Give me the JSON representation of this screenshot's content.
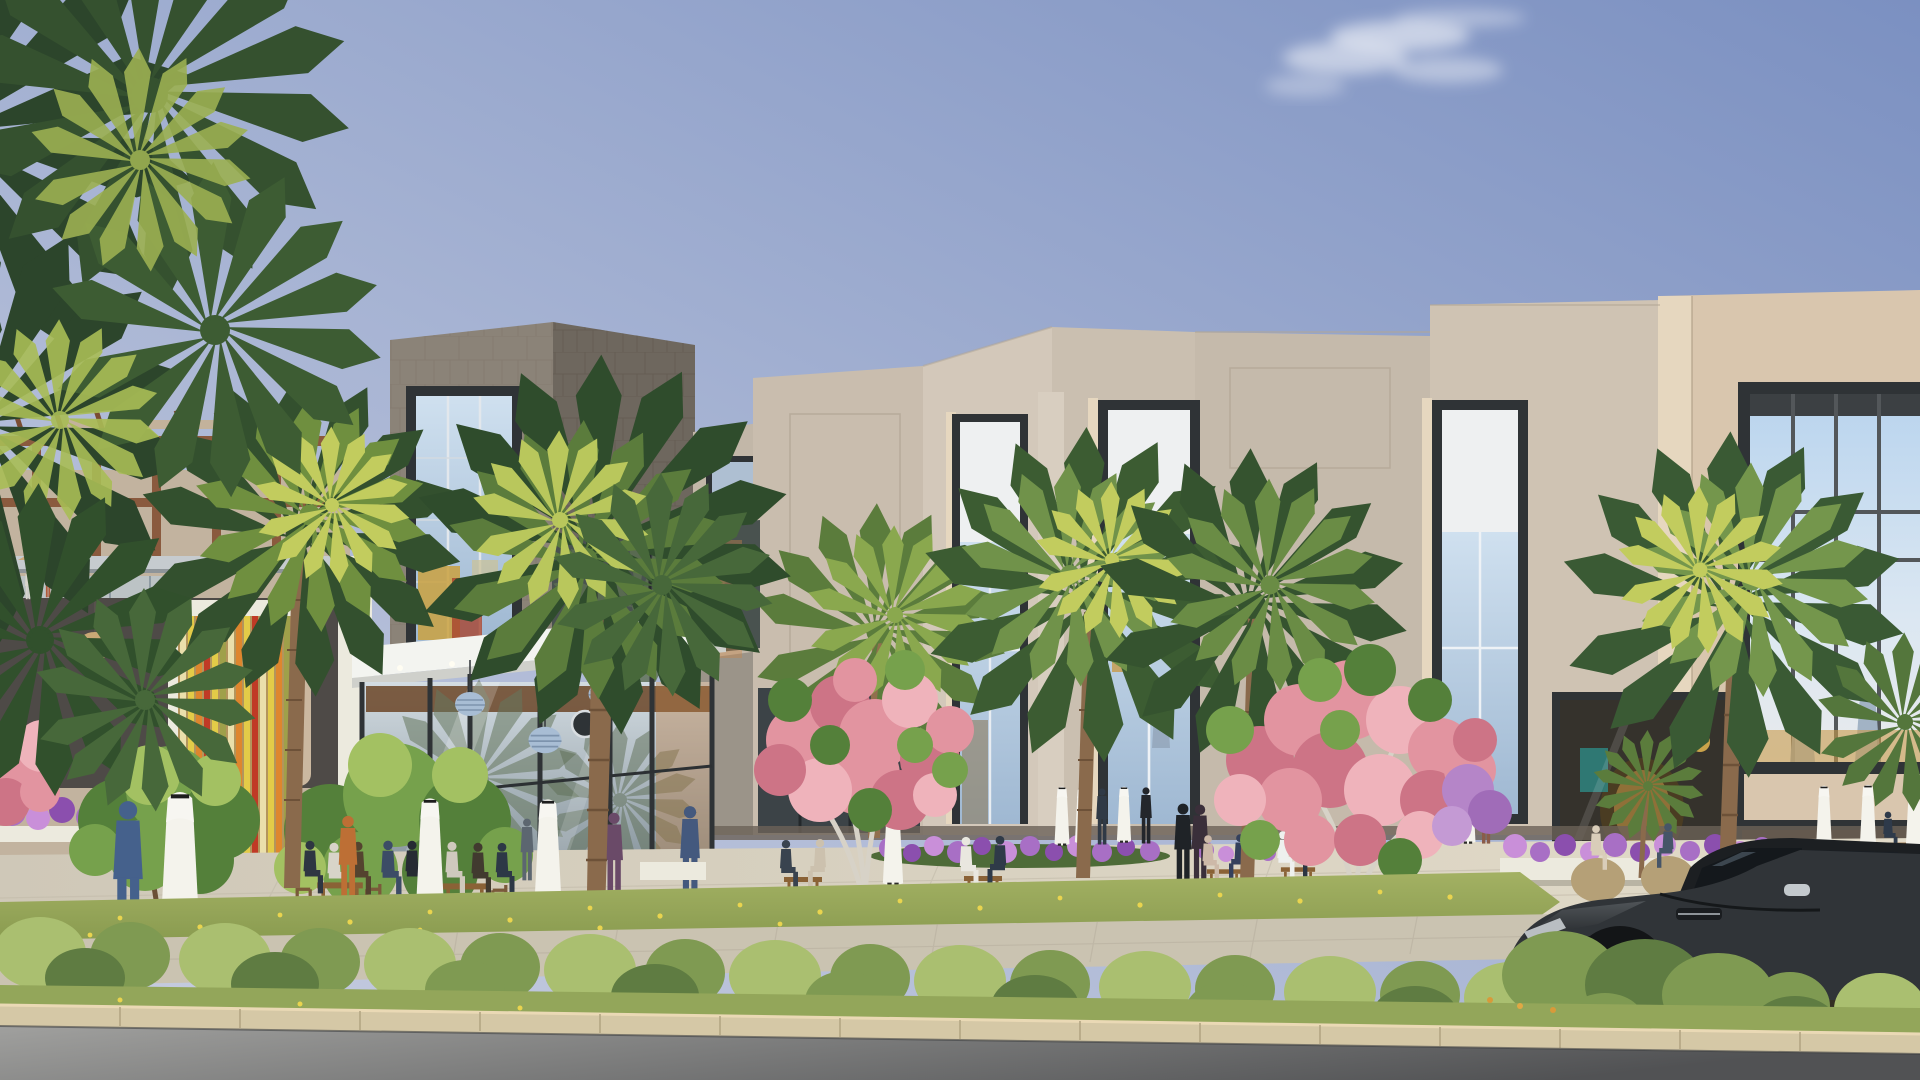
{
  "scene": {
    "type": "architectural-rendering",
    "description": "Daytime exterior rendering of a modern two-storey retail mall with beige stone facades, tall dark-framed shop windows, a grey stone gallery cube, a glass entrance pavilion with pendant lamps, a colourful striped slat wall, fan palms, pink flowering trees, pedestrians in white thobes and abayas, outdoor cafe seating, purple flower beds, a clipped hedge over a stone curb, and a dark luxury coupe parked on the asphalt road in the foreground",
    "elements": [
      {
        "name": "sky",
        "description": "clear blue gradient sky, deeper at top right"
      },
      {
        "name": "cloud",
        "description": "single wispy white cloud upper centre-right"
      },
      {
        "name": "left-terrace-pavilion",
        "description": "two-level terrace with timber pergola, steel frame and rattan pendant lamps"
      },
      {
        "name": "striped-slat-wall",
        "description": "vertical slats in yellow, orange, red, olive and cream"
      },
      {
        "name": "stone-cube-gallery",
        "description": "grey stone-clad cube volume with large mullioned glass wall"
      },
      {
        "name": "main-facade",
        "description": "faceted beige stone facade blocks with stepped parapets"
      },
      {
        "name": "tall-shop-windows",
        "description": "three double-height dark framed windows with roller shades"
      },
      {
        "name": "mannequin-display-window",
        "description": "large gridded window on right block with mannequins"
      },
      {
        "name": "boutique-storefront",
        "description": "warm gold and teal lit boutique interiors at ground level"
      },
      {
        "name": "entrance-glass-pavilion",
        "description": "white canopy glass pavilion with blue pendant lamps and round logo plaque"
      },
      {
        "name": "palm-trees",
        "description": "nine fan palms across the plaza plus overhanging fronds top left"
      },
      {
        "name": "pink-flowering-trees",
        "description": "three pink blossom trees with pale trunks"
      },
      {
        "name": "green-trees",
        "description": "two round leafy green trees at left"
      },
      {
        "name": "pedestrians",
        "description": "about thirty figures: men in white thobes, women in abayas, casual visitors"
      },
      {
        "name": "outdoor-cafe-seating",
        "description": "wooden tables and chairs plus wicker pod chairs"
      },
      {
        "name": "flower-beds",
        "description": "purple petunia beds and lawn dotted with yellow flowers"
      },
      {
        "name": "hedge-and-curb",
        "description": "loose green hedge over beige stone curb blocks"
      },
      {
        "name": "road",
        "description": "asphalt road across the bottom foreground"
      },
      {
        "name": "luxury-coupe",
        "description": "dark grey sports coupe partly hidden behind the hedge, bottom right"
      }
    ]
  },
  "palette": {
    "sky_top": "#7b90c1",
    "sky_mid": "#a6b3d3",
    "sky_low": "#c5cbdf",
    "cloud_white": "#ffffff",
    "stone_front": "#8b8378",
    "stone_side": "#6e675e",
    "facade_light": "#d3c8ba",
    "facade_mid": "#c9bdae",
    "facade_shadow": "#b3a795",
    "facade_warm": "#d9c6ae",
    "facade_lit_edge": "#e6d7bf",
    "frame_dark": "#2f3336",
    "glass_sky": "#bdd3e8",
    "glass_shade": "#eef0f1",
    "canopy_white": "#f3f4f0",
    "stripe_yellow": "#e3cb48",
    "stripe_orange": "#de862e",
    "stripe_red": "#c03a26",
    "stripe_olive": "#9fa04a",
    "stripe_cream": "#eadfab",
    "slat_bg": "#b3955c",
    "pergola_brown": "#8a5a3e",
    "steel_gray": "#c6cbcf",
    "palm_dark": "#33502e",
    "palm_mid": "#5b7c3c",
    "palm_light": "#8aa84e",
    "palm_sun": "#c2cc5e",
    "trunk_brown": "#8a6a4c",
    "pink_blossom": "#e294a0",
    "pink_deep": "#cd7486",
    "pink_light": "#efb3bb",
    "tree_green": "#76a14c",
    "tree_green_dark": "#54803a",
    "tree_green_light": "#a3c162",
    "hedge_green": "#7f9a52",
    "hedge_light": "#aabf70",
    "hedge_dark": "#5f7c42",
    "grass": "#93a65a",
    "flower_yellow": "#e9d44f",
    "flower_purple": "#a86fc5",
    "flower_purple_deep": "#8b4fae",
    "flower_purple_light": "#c98fd9",
    "pavement": "#d8d2c3",
    "paver": "#cac3b1",
    "curb": "#d5c8a6",
    "road_light": "#a0a09e",
    "road_dark": "#515254",
    "car_body": "#303438",
    "car_dark": "#1c1f22",
    "car_glass": "#14181c",
    "rim_silver": "#a7adb2",
    "thobe_white": "#f4f3ec",
    "skin": "#c99a78",
    "wood": "#8a6236",
    "wicker": "#b5a077",
    "interior_warm": "#c89a4a",
    "teal_accent": "#2e8a86",
    "white_trim": "#eceade"
  }
}
